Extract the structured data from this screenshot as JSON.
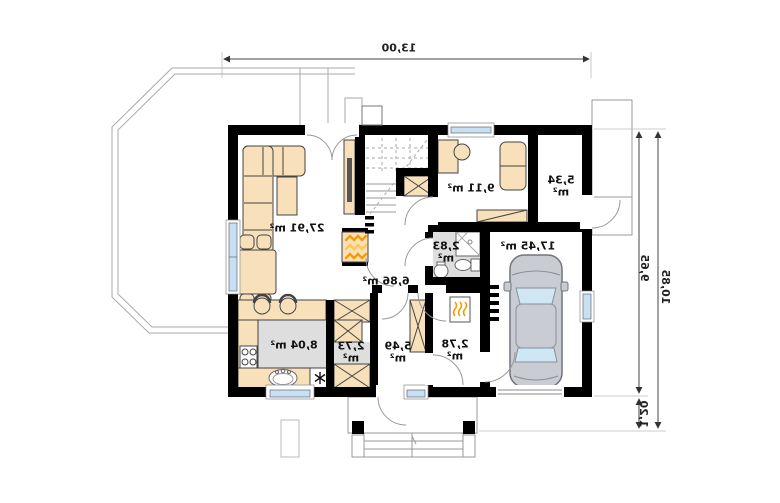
{
  "plan": {
    "type": "floor-plan-mirrored",
    "rooms": {
      "living": {
        "area": "27,91 m²"
      },
      "kitchen": {
        "area": "8,04 m²"
      },
      "hall": {
        "area": "6,86 m²"
      },
      "office": {
        "area": "9,11 m²"
      },
      "storage": {
        "area": "5,34",
        "unit": "m²"
      },
      "garage": {
        "area": "17,45 m²"
      },
      "bathroom": {
        "area": "2,83",
        "unit": "m²"
      },
      "pantry": {
        "area": "2,73",
        "unit": "m²"
      },
      "corridor": {
        "area": "5,49",
        "unit": "m²"
      },
      "vestibule": {
        "area": "2,78",
        "unit": "m²"
      }
    },
    "dimensions": {
      "width_total": "13,00",
      "height_main": "9,65",
      "height_total": "10,85",
      "porch_depth": "1,20"
    },
    "colors": {
      "wall": "#000000",
      "furniture": "#f8e1ba",
      "glass": "#c7e0f2",
      "floor_grey": "#dcdcdc",
      "flame_orange": "#f59d00",
      "flame_yellow": "#ffc84d",
      "car_body": "#c9cdd3",
      "car_glass": "#cfe6f5",
      "outline_grey": "#9aa0a6"
    },
    "icons": {
      "fireplace": "flame-zigzag",
      "heater": "flame-zigzag-small",
      "fridge": "snowflake-asterisk",
      "wardrobe": "rect-with-x",
      "radiator": "comb-bars",
      "stove": "four-burners",
      "sink": "oval-basin"
    }
  }
}
